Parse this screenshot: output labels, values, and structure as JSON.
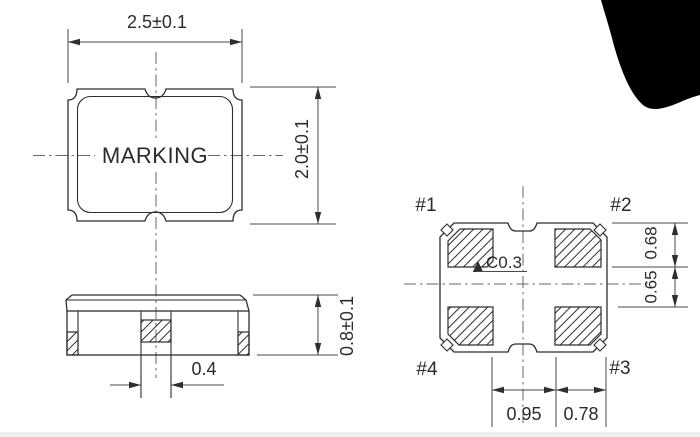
{
  "drawing": {
    "description": "SMD package outline drawing with top, side and bottom (land pattern) views",
    "background_color": "#ffffff",
    "line_color": "#2e2e2e",
    "dimension_line_color": "#4a4a4a",
    "text_color": "#2b2b2b",
    "artifact_color": "#000000",
    "top_view": {
      "marking": "MARKING",
      "body_width": "2.5±0.1",
      "body_height": "2.0±0.1"
    },
    "side_view": {
      "body_thickness": "0.8±0.1",
      "center_pad_width": "0.4"
    },
    "bottom_view": {
      "pad1": "#1",
      "pad2": "#2",
      "pad3": "#3",
      "pad4": "#4",
      "corner_chamfer": "C0.3",
      "pad_length": "0.68",
      "pad_gap_vertical": "0.65",
      "pad_gap_horizontal": "0.95",
      "pad_width": "0.78"
    }
  }
}
